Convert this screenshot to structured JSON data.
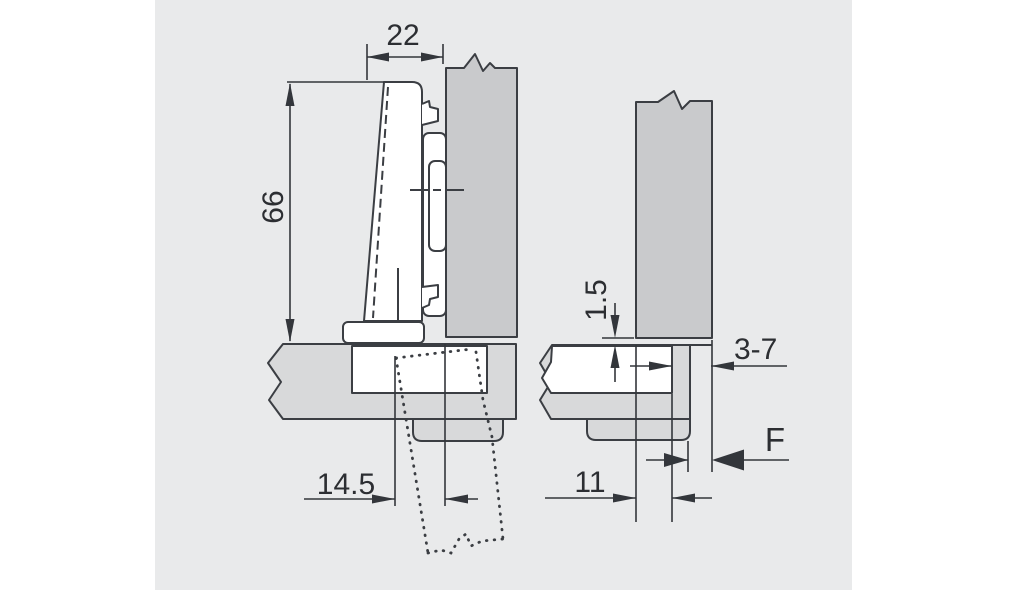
{
  "diagram": {
    "kind": "hinge-mounting-technical-drawing",
    "colors": {
      "canvas": "#e9eaeb",
      "door_panel": "#c9cacc",
      "cabinet_panel": "#d8d9da",
      "cutout": "#ffffff",
      "line": "#3b3e43"
    },
    "left_view": {
      "dims": {
        "arm_width": "22",
        "arm_height": "66",
        "front_offset": "14.5"
      }
    },
    "right_view": {
      "dims": {
        "vertical_gap": "1.5",
        "edge_distance": "3-7",
        "overlay_gap": "F",
        "cup_distance": "11"
      }
    }
  }
}
